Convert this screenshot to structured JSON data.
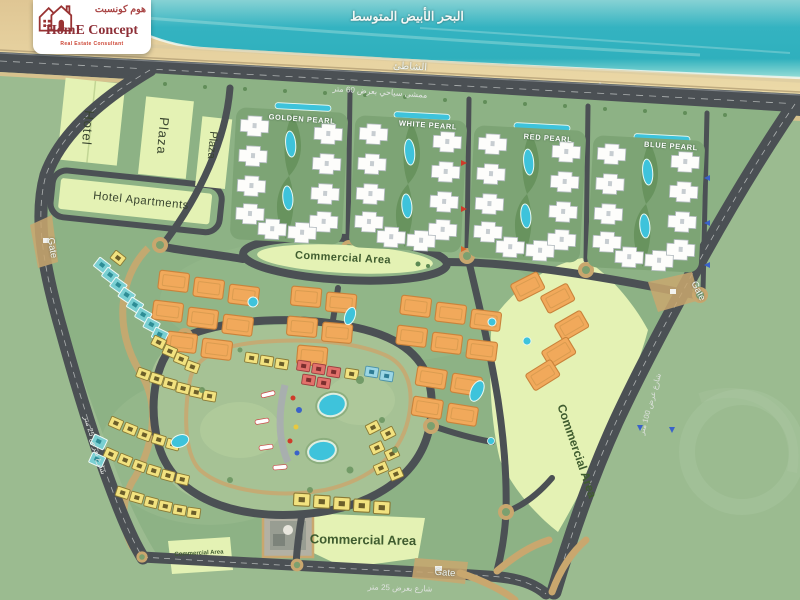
{
  "colors": {
    "sea": "#2fb0bd",
    "sand": "#e9d6a3",
    "road": "#4b5054",
    "site_green": "#8db285",
    "outside_green": "#9bbb90",
    "park_green": "#a6c295",
    "zone_light": "#e4f2b4",
    "building_white": "#fdfdfb",
    "building_orange": "#f1a95b",
    "villa_yellow": "#f2e27f",
    "villa_red": "#e2716b",
    "villa_teal": "#79cfd2",
    "pool_cyan": "#3ec3db",
    "path_tan": "#c9a76e",
    "brand_maroon": "#8e3038",
    "commercial_text": "#3f5c2f"
  },
  "logo": {
    "name_ar": "هوم كونسبت",
    "name_en": "HomE Concept",
    "tagline": "Real Estate Consultant"
  },
  "map": {
    "sea_label": "البحر الأبيض المتوسط",
    "beach_label": "الشاطئ",
    "promenade_label": "ممشى سياحي بعرض 60 متر",
    "left_street_label": "شارع بعرض 25 متر",
    "right_street_label": "شارع عرض 100 متر",
    "bottom_street_label": "شارع بعرض 25 متر"
  },
  "zones": {
    "hotel": "Hotel",
    "plaza_1": "Plaza",
    "plaza_2": "Plaza",
    "hotel_apartments": "Hotel Apartments",
    "golden_pearl": "GOLDEN PEARL",
    "white_pearl": "WHITE PEARL",
    "red_pearl": "RED PEARL",
    "blue_pearl": "BLUE PEARL",
    "commercial_center": "Commercial Area",
    "commercial_right": "Commercial Area",
    "commercial_bottom": "Commercial Area",
    "commercial_small": "Commercial Area"
  },
  "gates": {
    "left": "Gate",
    "right": "Gate",
    "bottom": "Gate"
  }
}
